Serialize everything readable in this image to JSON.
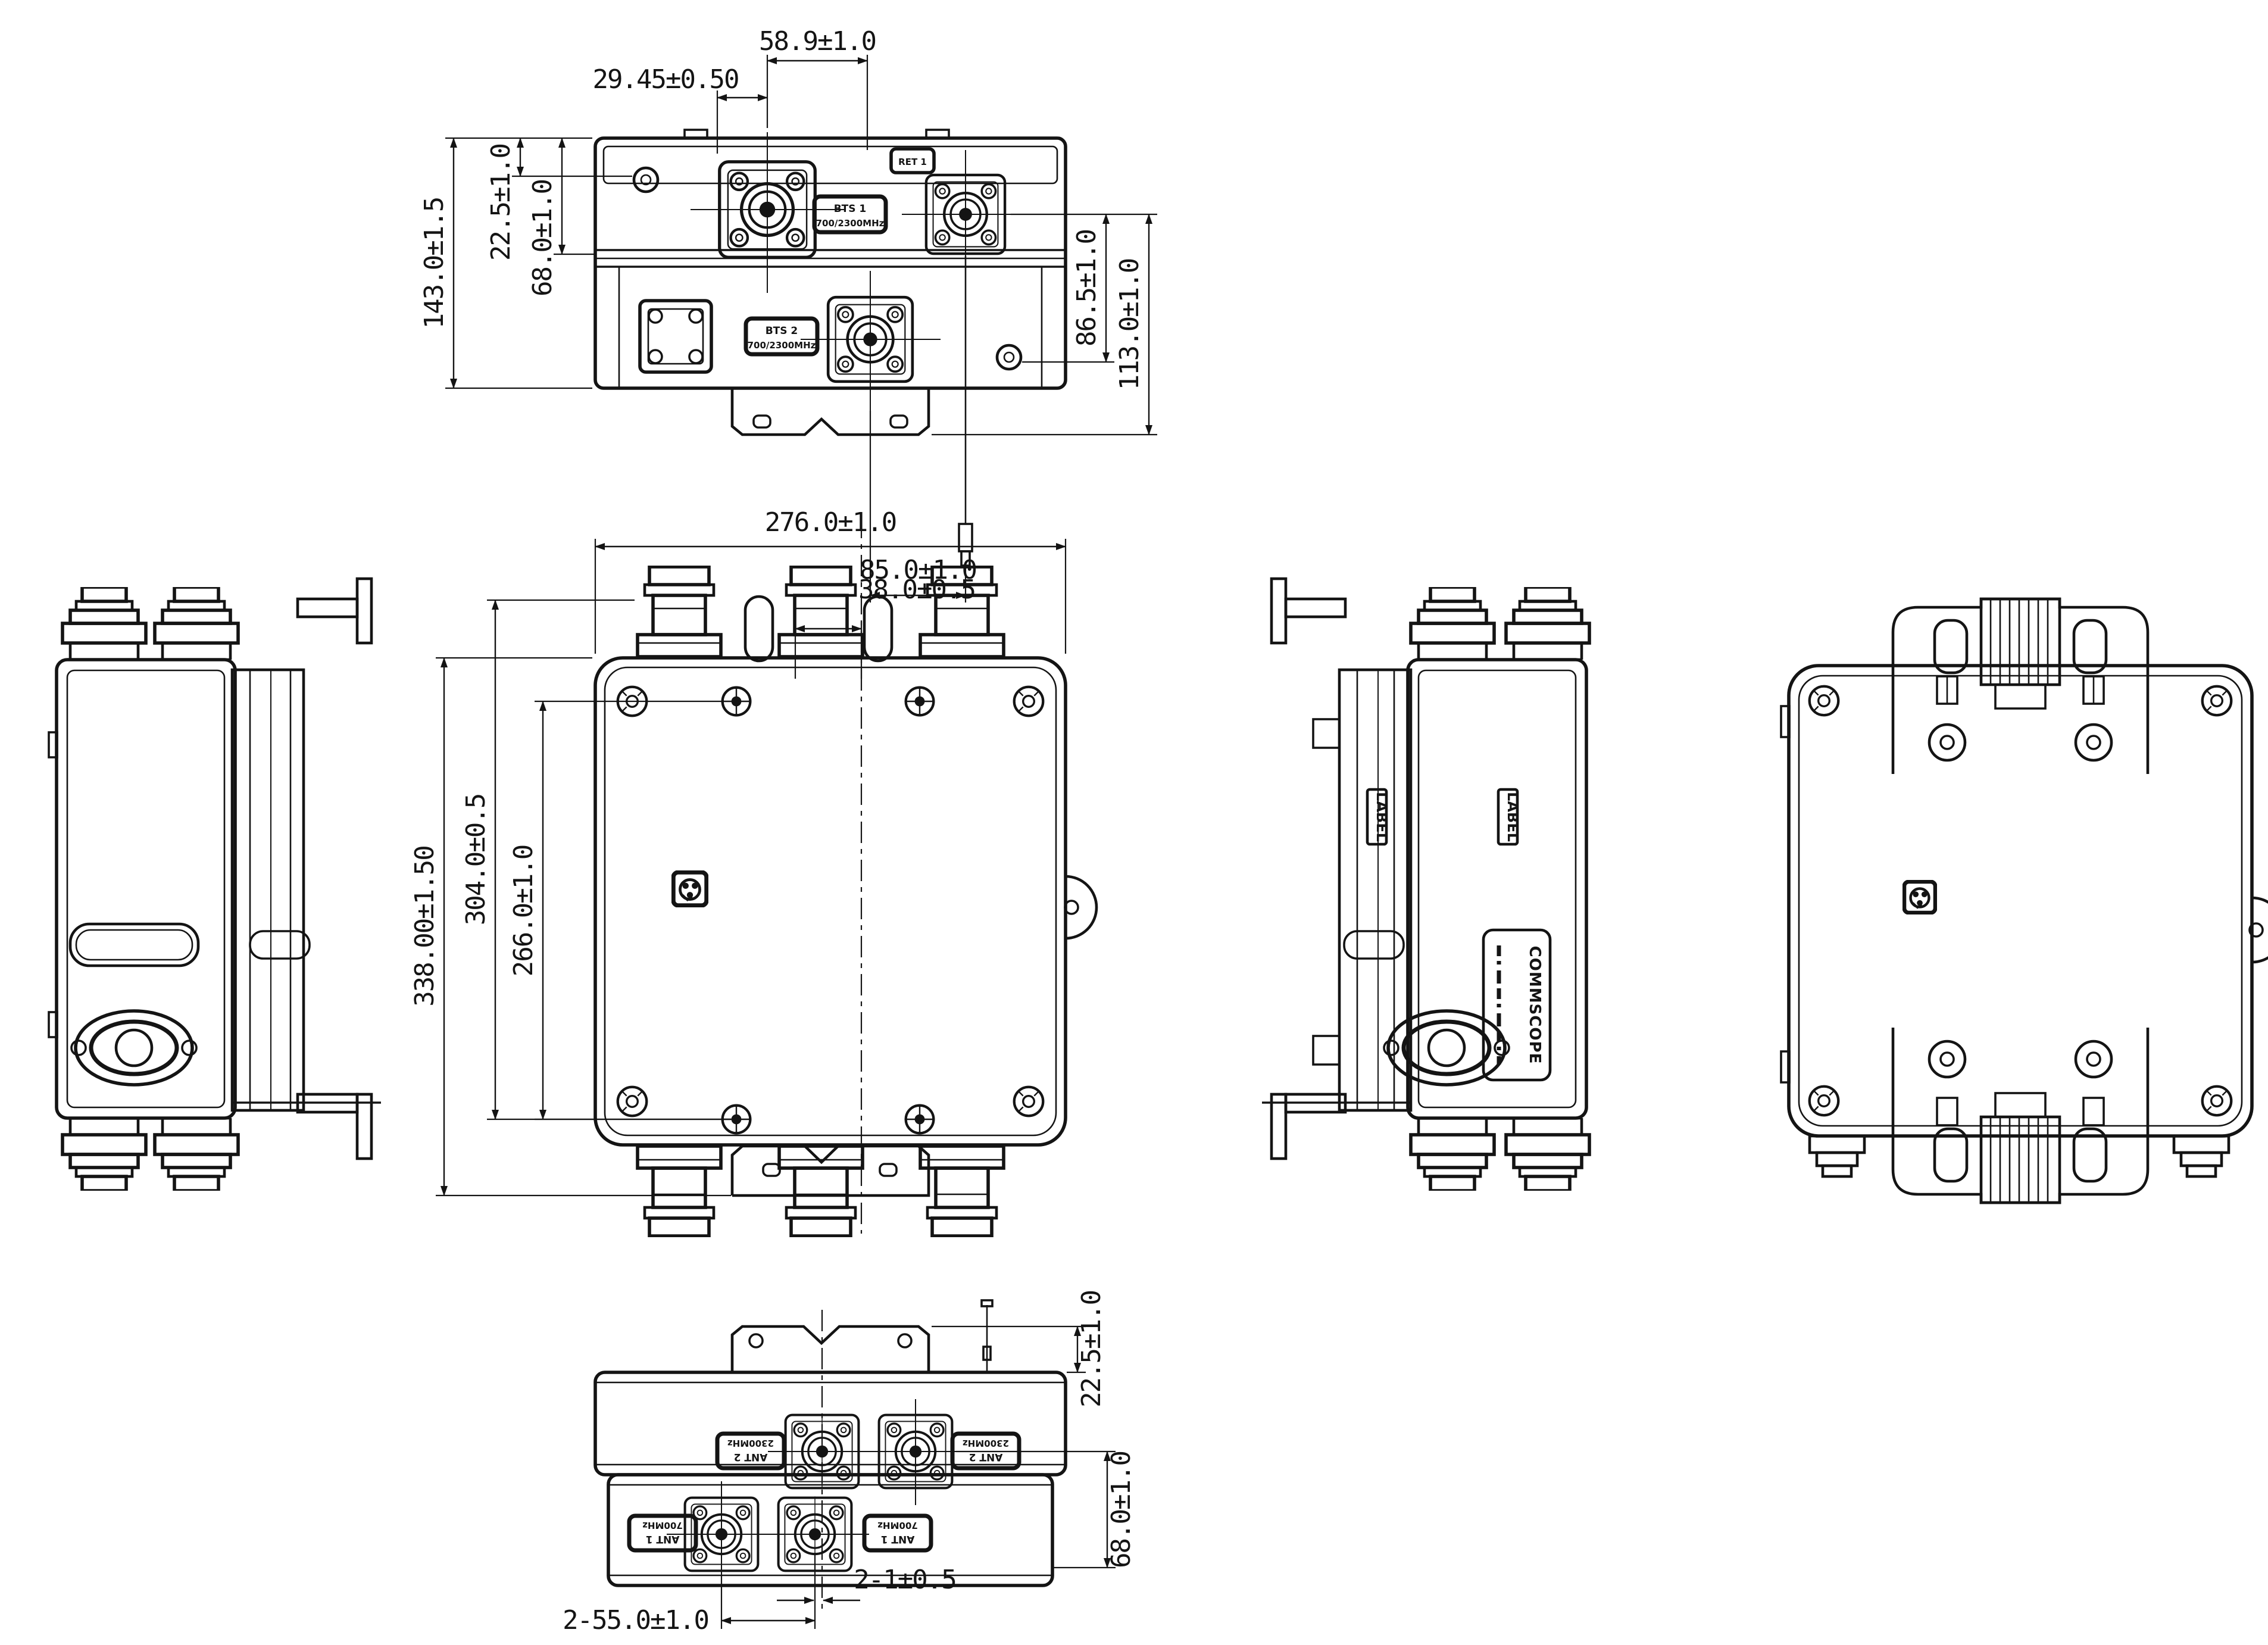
{
  "colors": {
    "ink": "#141414",
    "paper": "#ffffff"
  },
  "top": {
    "dims": {
      "port_pitch": "58.9±1.0",
      "port_offset": "29.45±0.50",
      "depth": "143.0±1.5",
      "step": "22.5±1.0",
      "conn_depth": "68.0±1.0",
      "right_inner": "86.5±1.0",
      "right_outer": "113.0±1.0",
      "tether": "85.0±1.0"
    },
    "labels": {
      "bts1": "BTS 1",
      "bts1_freq": "700/2300MHz",
      "ret": "RET 1",
      "bts2": "BTS 2",
      "bts2_freq": "700/2300MHz"
    }
  },
  "front": {
    "dims": {
      "width": "276.0±1.0",
      "port_offset": "38.0±0.5",
      "height_overall": "338.00±1.50",
      "height_mount": "304.0±0.5",
      "height_screws": "266.0±1.0"
    }
  },
  "right_view": {
    "labels": {
      "tag": "LABEL",
      "brand": "COMMSCOPE"
    }
  },
  "bottom": {
    "dims": {
      "bracket": "22.5±1.0",
      "conn_depth": "68.0±1.0",
      "port_pitch": "2-55.0±1.0",
      "center_offset": "2-1±0.5"
    },
    "labels": {
      "ant2": "ANT 2",
      "ant2_freq": "2300MHz",
      "ant1": "ANT 1",
      "ant1_freq": "700MHz"
    }
  }
}
